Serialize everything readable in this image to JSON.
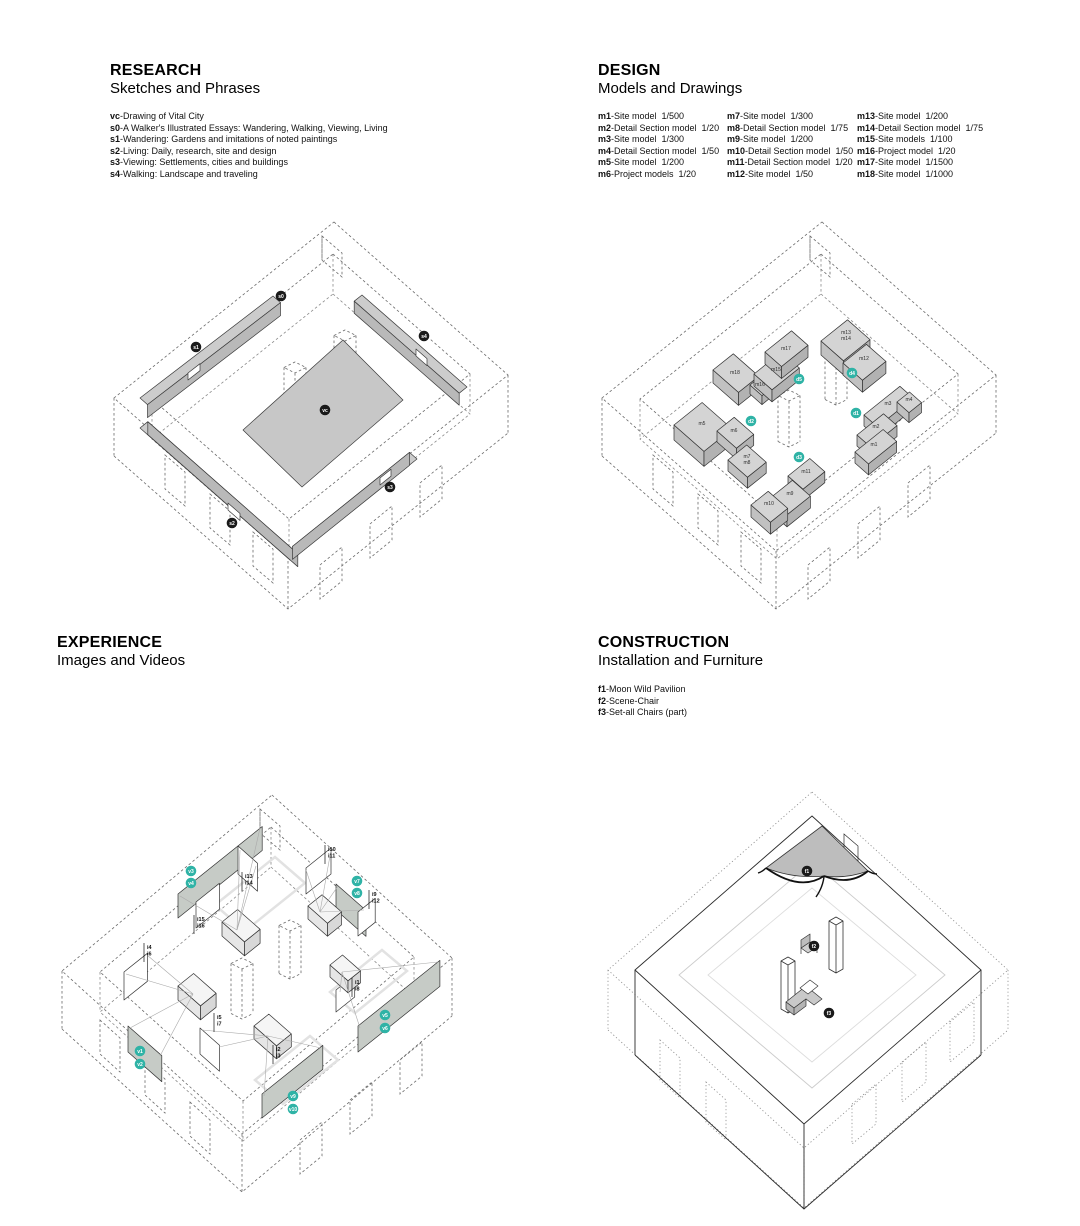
{
  "colors": {
    "accent_teal": "#2FB3A6",
    "marker_dark": "#1a1a1a",
    "model_gray": "#d2d2d2",
    "canopy_gray": "#bdbdbd"
  },
  "sections": {
    "research": {
      "title": "RESEARCH",
      "subtitle": "Sketches and Phrases",
      "legend": [
        {
          "id": "vc",
          "text": "Drawing of Vital City"
        },
        {
          "id": "s0",
          "text": "A Walker's Illustrated Essays: Wandering, Walking, Viewing, Living"
        },
        {
          "id": "s1",
          "text": "Wandering: Gardens and imitations of noted paintings"
        },
        {
          "id": "s2",
          "text": "Living: Daily, research, site and design"
        },
        {
          "id": "s3",
          "text": "Viewing: Settlements, cities and buildings"
        },
        {
          "id": "s4",
          "text": "Walking: Landscape and traveling"
        }
      ]
    },
    "design": {
      "title": "DESIGN",
      "subtitle": "Models and Drawings",
      "legend_columns": [
        [
          {
            "id": "m1",
            "text": "Site model",
            "scale": "1/500"
          },
          {
            "id": "m2",
            "text": "Detail Section model",
            "scale": "1/20"
          },
          {
            "id": "m3",
            "text": "Site model",
            "scale": "1/300"
          },
          {
            "id": "m4",
            "text": "Detail Section model",
            "scale": "1/50"
          },
          {
            "id": "m5",
            "text": "Site model",
            "scale": "1/200"
          },
          {
            "id": "m6",
            "text": "Project models",
            "scale": "1/20"
          }
        ],
        [
          {
            "id": "m7",
            "text": "Site model",
            "scale": "1/300"
          },
          {
            "id": "m8",
            "text": "Detail Section model",
            "scale": "1/75"
          },
          {
            "id": "m9",
            "text": "Site model",
            "scale": "1/200"
          },
          {
            "id": "m10",
            "text": "Detail Section model",
            "scale": "1/50"
          },
          {
            "id": "m11",
            "text": "Detail Section model",
            "scale": "1/20"
          },
          {
            "id": "m12",
            "text": "Site model",
            "scale": "1/50"
          }
        ],
        [
          {
            "id": "m13",
            "text": "Site model",
            "scale": "1/200"
          },
          {
            "id": "m14",
            "text": "Detail Section model",
            "scale": "1/75"
          },
          {
            "id": "m15",
            "text": "Site models",
            "scale": "1/100"
          },
          {
            "id": "m16",
            "text": "Project model",
            "scale": "1/20"
          },
          {
            "id": "m17",
            "text": "Site model",
            "scale": "1/1500"
          },
          {
            "id": "m18",
            "text": "Site model",
            "scale": "1/1000"
          }
        ]
      ]
    },
    "experience": {
      "title": "EXPERIENCE",
      "subtitle": "Images and Videos"
    },
    "construction": {
      "title": "CONSTRUCTION",
      "subtitle": "Installation and Furniture",
      "legend": [
        {
          "id": "f1",
          "text": "Moon Wild Pavilion"
        },
        {
          "id": "f2",
          "text": "Scene-Chair"
        },
        {
          "id": "f3",
          "text": "Set-all Chairs (part)"
        }
      ]
    }
  },
  "drawing_labels": {
    "research_markers": [
      {
        "label": "s0",
        "x": 281,
        "y": 296
      },
      {
        "label": "s1",
        "x": 196,
        "y": 347
      },
      {
        "label": "s2",
        "x": 232,
        "y": 523
      },
      {
        "label": "s3",
        "x": 390,
        "y": 487
      },
      {
        "label": "s4",
        "x": 424,
        "y": 336
      },
      {
        "label": "vc",
        "x": 325,
        "y": 410
      }
    ],
    "design_drawing_markers": [
      {
        "label": "d1",
        "x": 856,
        "y": 413
      },
      {
        "label": "d2",
        "x": 751,
        "y": 421
      },
      {
        "label": "d3",
        "x": 799,
        "y": 457
      },
      {
        "label": "d4",
        "x": 852,
        "y": 373
      },
      {
        "label": "d5",
        "x": 799,
        "y": 379
      }
    ],
    "design_model_labels": [
      {
        "label": "m1",
        "x": 874,
        "y": 446
      },
      {
        "label": "m2",
        "x": 876,
        "y": 428
      },
      {
        "label": "m3",
        "x": 888,
        "y": 405
      },
      {
        "label": "m4",
        "x": 909,
        "y": 401
      },
      {
        "label": "m5",
        "x": 702,
        "y": 425
      },
      {
        "label": "m6",
        "x": 734,
        "y": 432
      },
      {
        "label": "m7",
        "x": 747,
        "y": 458
      },
      {
        "label": "m8",
        "x": 747,
        "y": 464
      },
      {
        "label": "m9",
        "x": 790,
        "y": 495
      },
      {
        "label": "m10",
        "x": 769,
        "y": 505
      },
      {
        "label": "m11",
        "x": 806,
        "y": 473
      },
      {
        "label": "m12",
        "x": 864,
        "y": 360
      },
      {
        "label": "m13",
        "x": 846,
        "y": 334
      },
      {
        "label": "m14",
        "x": 846,
        "y": 340
      },
      {
        "label": "m15",
        "x": 776,
        "y": 371
      },
      {
        "label": "m16",
        "x": 760,
        "y": 386
      },
      {
        "label": "m17",
        "x": 786,
        "y": 350
      },
      {
        "label": "m18",
        "x": 735,
        "y": 374
      }
    ],
    "experience_image_labels": [
      {
        "lines": [
          "i13",
          "i14"
        ],
        "x": 245,
        "y": 878
      },
      {
        "lines": [
          "i15",
          "i16"
        ],
        "x": 197,
        "y": 921
      },
      {
        "lines": [
          "i10",
          "i11"
        ],
        "x": 328,
        "y": 851
      },
      {
        "lines": [
          "i9",
          "i12"
        ],
        "x": 372,
        "y": 896
      },
      {
        "lines": [
          "i4",
          "i6"
        ],
        "x": 147,
        "y": 949
      },
      {
        "lines": [
          "i1",
          "i8"
        ],
        "x": 355,
        "y": 984
      },
      {
        "lines": [
          "i5",
          "i7"
        ],
        "x": 217,
        "y": 1019
      },
      {
        "lines": [
          "i2",
          "i3"
        ],
        "x": 276,
        "y": 1051
      }
    ],
    "experience_video_markers": [
      {
        "label": "v3",
        "x": 191,
        "y": 871
      },
      {
        "label": "v4",
        "x": 191,
        "y": 883
      },
      {
        "label": "v7",
        "x": 357,
        "y": 881
      },
      {
        "label": "v8",
        "x": 357,
        "y": 893
      },
      {
        "label": "v5",
        "x": 385,
        "y": 1015
      },
      {
        "label": "v6",
        "x": 385,
        "y": 1028
      },
      {
        "label": "v1",
        "x": 140,
        "y": 1051
      },
      {
        "label": "v2",
        "x": 140,
        "y": 1064
      },
      {
        "label": "v9",
        "x": 293,
        "y": 1096
      },
      {
        "label": "v10",
        "x": 293,
        "y": 1109
      }
    ],
    "construction_markers": [
      {
        "label": "f1",
        "x": 807,
        "y": 871
      },
      {
        "label": "f2",
        "x": 814,
        "y": 946
      },
      {
        "label": "f3",
        "x": 829,
        "y": 1013
      }
    ]
  }
}
